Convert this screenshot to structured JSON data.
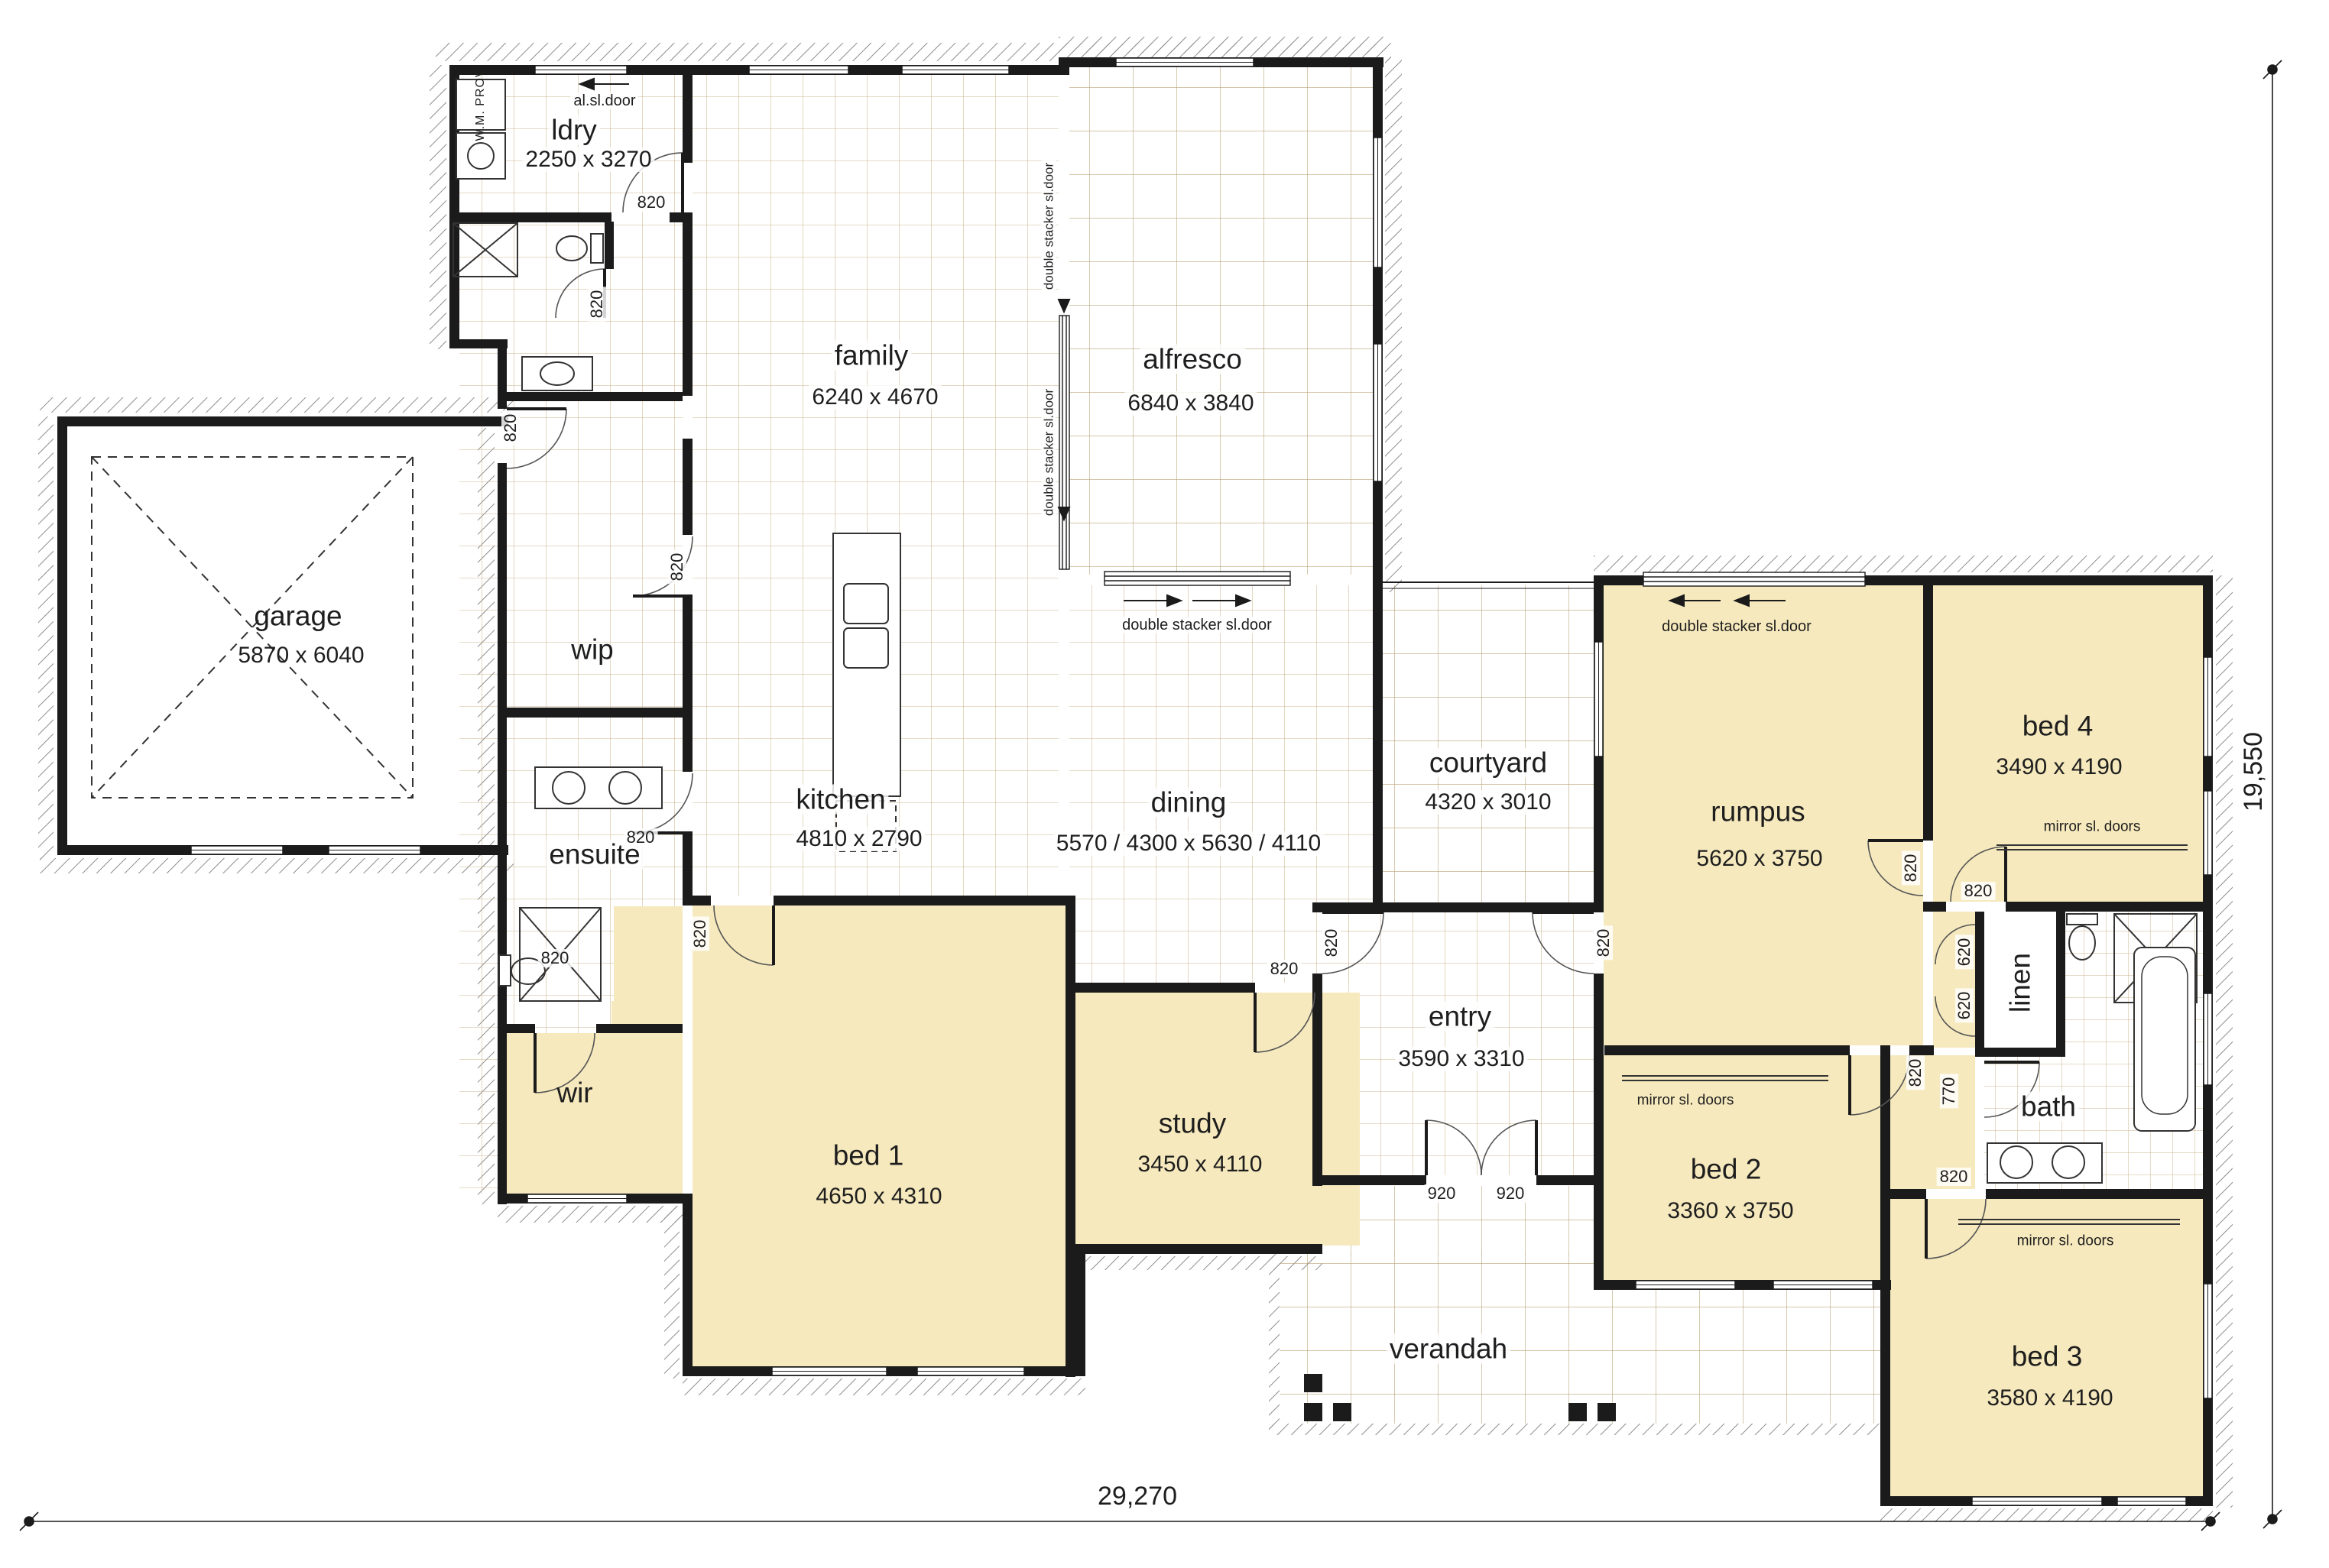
{
  "plan": {
    "rooms": [
      {
        "name": "ldry",
        "dims": "2250 x 3270"
      },
      {
        "name": "family",
        "dims": "6240 x 4670"
      },
      {
        "name": "alfresco",
        "dims": "6840 x 3840"
      },
      {
        "name": "garage",
        "dims": "5870 x 6040"
      },
      {
        "name": "wip",
        "dims": ""
      },
      {
        "name": "kitchen",
        "dims": "4810 x 2790"
      },
      {
        "name": "dining",
        "dims": "5570 / 4300 x 5630 / 4110"
      },
      {
        "name": "courtyard",
        "dims": "4320 x 3010"
      },
      {
        "name": "rumpus",
        "dims": "5620 x 3750"
      },
      {
        "name": "bed 4",
        "dims": "3490 x 4190"
      },
      {
        "name": "ensuite",
        "dims": ""
      },
      {
        "name": "wir",
        "dims": ""
      },
      {
        "name": "bed 1",
        "dims": "4650 x 4310"
      },
      {
        "name": "study",
        "dims": "3450 x 4110"
      },
      {
        "name": "entry",
        "dims": "3590 x 3310"
      },
      {
        "name": "bed 2",
        "dims": "3360 x 3750"
      },
      {
        "name": "linen",
        "dims": ""
      },
      {
        "name": "bath",
        "dims": ""
      },
      {
        "name": "bed 3",
        "dims": "3580 x 4190"
      },
      {
        "name": "verandah",
        "dims": ""
      }
    ],
    "annotations": {
      "al_sl_door": "al.sl.door",
      "wm_prov": "W.M. PROV",
      "double_stacker": "double stacker sl.door",
      "mirror_doors": "mirror sl. doors"
    },
    "door_widths": {
      "w820": "820",
      "w920": "920",
      "w620": "620",
      "w770": "770"
    },
    "overall": {
      "width": "29,270",
      "height": "19,550"
    },
    "colors": {
      "room_fill": "#f6e9bd",
      "wall": "#1b1b1b",
      "tile_line": "#c4a97c"
    }
  }
}
